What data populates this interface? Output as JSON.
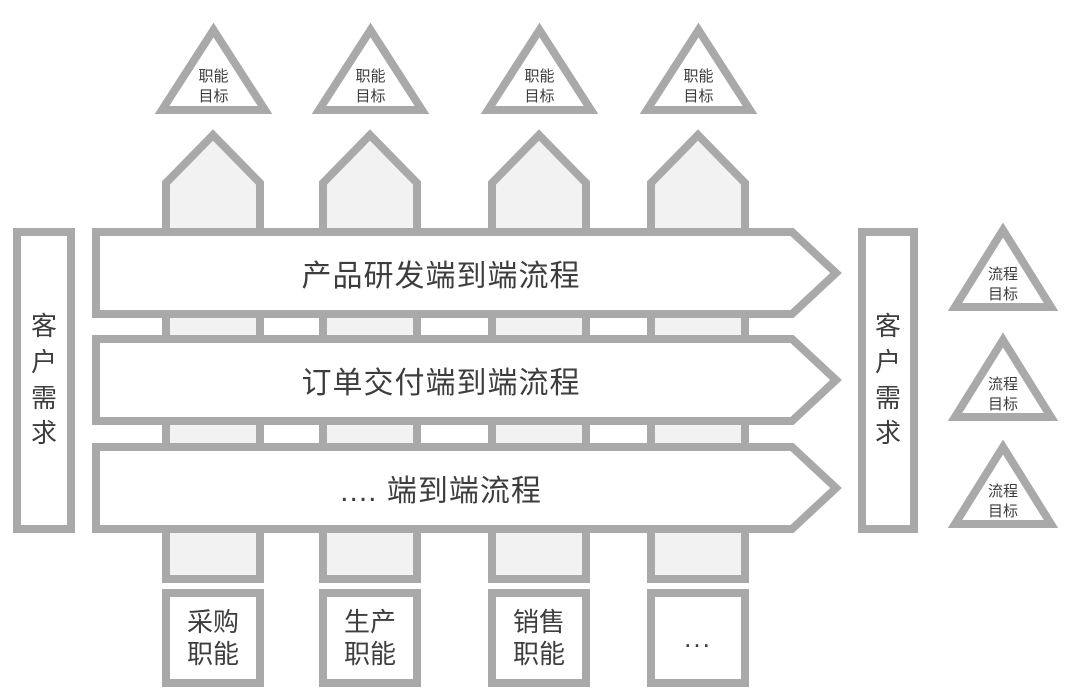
{
  "colors": {
    "shape_border": "#a9a9a9",
    "column_fill": "#f2f2f2",
    "shape_fill": "#ffffff",
    "text": "#3d3d3d"
  },
  "top_goals": {
    "items": [
      {
        "label": "职能目标"
      },
      {
        "label": "职能目标"
      },
      {
        "label": "职能目标"
      },
      {
        "label": "职能目标"
      }
    ]
  },
  "process_rows": {
    "items": [
      {
        "label": "产品研发端到端流程"
      },
      {
        "label": "订单交付端到端流程"
      },
      {
        "label": ".... 端到端流程"
      }
    ]
  },
  "left_bar": {
    "label": "客户需求"
  },
  "right_bar": {
    "label": "客户需求"
  },
  "process_goals": {
    "items": [
      {
        "label": "流程目标"
      },
      {
        "label": "流程目标"
      },
      {
        "label": "流程目标"
      }
    ]
  },
  "functions": {
    "items": [
      {
        "label": "采购职能"
      },
      {
        "label": "生产职能"
      },
      {
        "label": "销售职能"
      },
      {
        "label": "..."
      }
    ]
  }
}
